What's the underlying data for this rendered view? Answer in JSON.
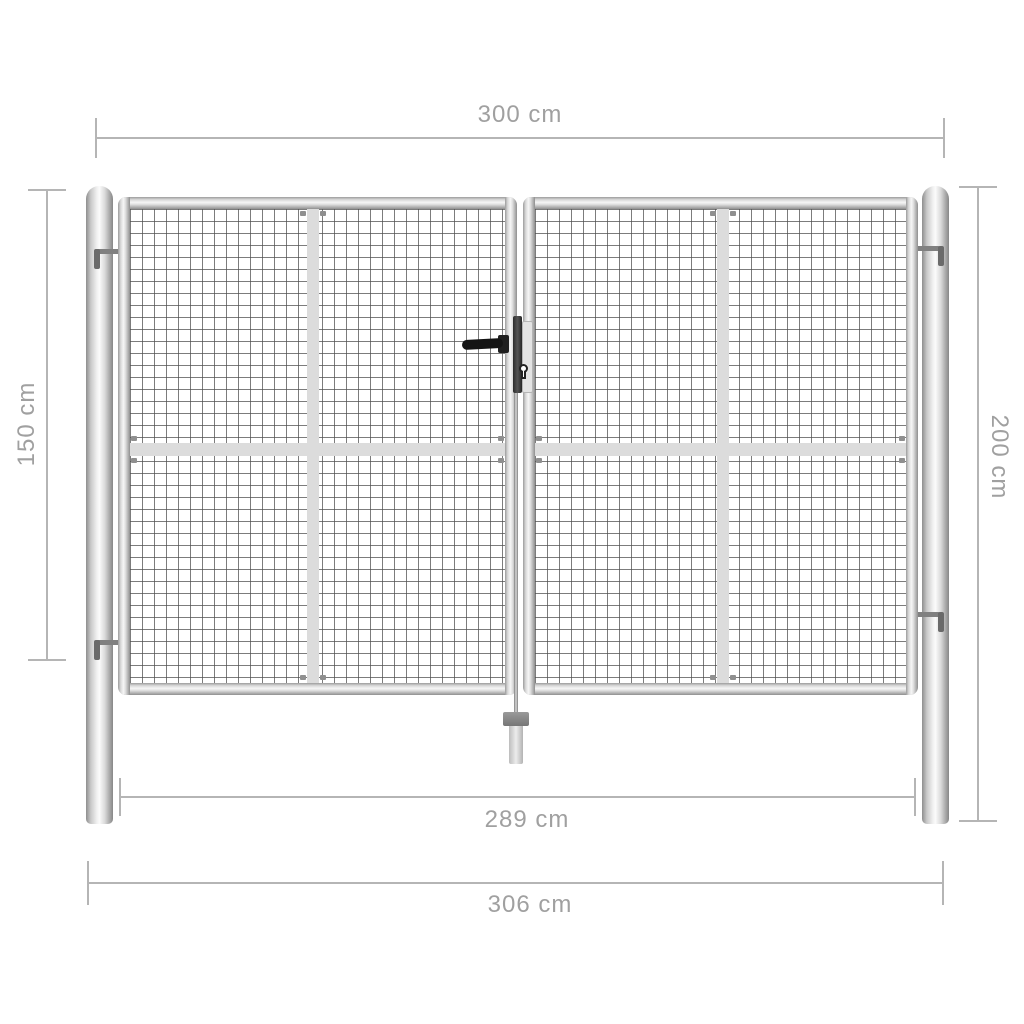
{
  "page": {
    "description": "Dimension diagram of a galvanised steel double garden gate with wire mesh panels, two round posts, centre handle with keyhole and ground drop rod"
  },
  "dimensions": {
    "overall_width_top": {
      "label": "300 cm"
    },
    "gate_height_left": {
      "label": "150 cm"
    },
    "post_height_right": {
      "label": "200 cm"
    },
    "inner_width_bottom": {
      "label": "289 cm"
    },
    "overall_width_bottom": {
      "label": "306 cm"
    }
  },
  "colors": {
    "background": "#ffffff",
    "dimension_line": "#b5b5b5",
    "dimension_text": "#a0a0a0",
    "metal_highlight": "#f6f6f6",
    "metal_shadow": "#8f8f8f",
    "mesh_wire": "#505050",
    "brace_rail": "#dcdcdc",
    "handle_black": "#141414"
  }
}
